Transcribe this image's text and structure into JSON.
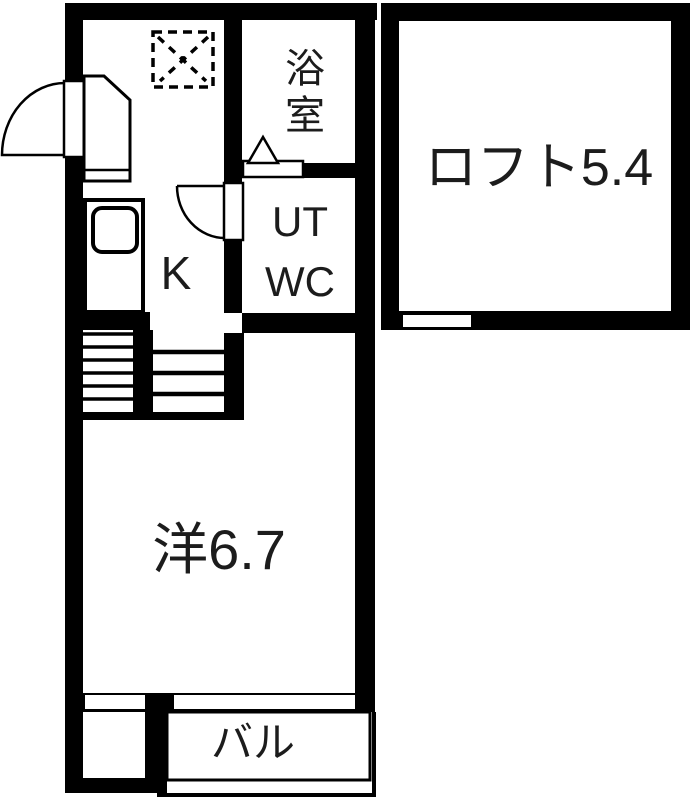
{
  "page": {
    "kind": "apartment-floor-plan",
    "background": "#ffffff"
  },
  "colors": {
    "wall": "#000000",
    "floor": "#ffffff",
    "line": "#1a1a1a"
  },
  "rooms": {
    "loft": {
      "label": "ロフト5.4"
    },
    "bath": {
      "label": "浴室"
    },
    "utwc": {
      "line1": "UT",
      "line2": "WC"
    },
    "kitchen": {
      "label": "K"
    },
    "main_room": {
      "label": "洋6.7"
    },
    "balcony": {
      "label": "バル"
    }
  },
  "symbols": {
    "refrigerator_space": "dashed-square-with-x",
    "entrance_door": "quarter-circle-swing",
    "utwc_door": "quarter-circle-swing",
    "bath_door": "triangle-and-bar",
    "stairs": "tread-lines",
    "kitchen_sink": "rounded-rect",
    "shoe_cabinet": "clipped-corner-box",
    "loft_window": "wall-opening",
    "window_left": "wall-opening",
    "window_balcony": "wall-opening",
    "balcony_railing": "thin-outline"
  }
}
